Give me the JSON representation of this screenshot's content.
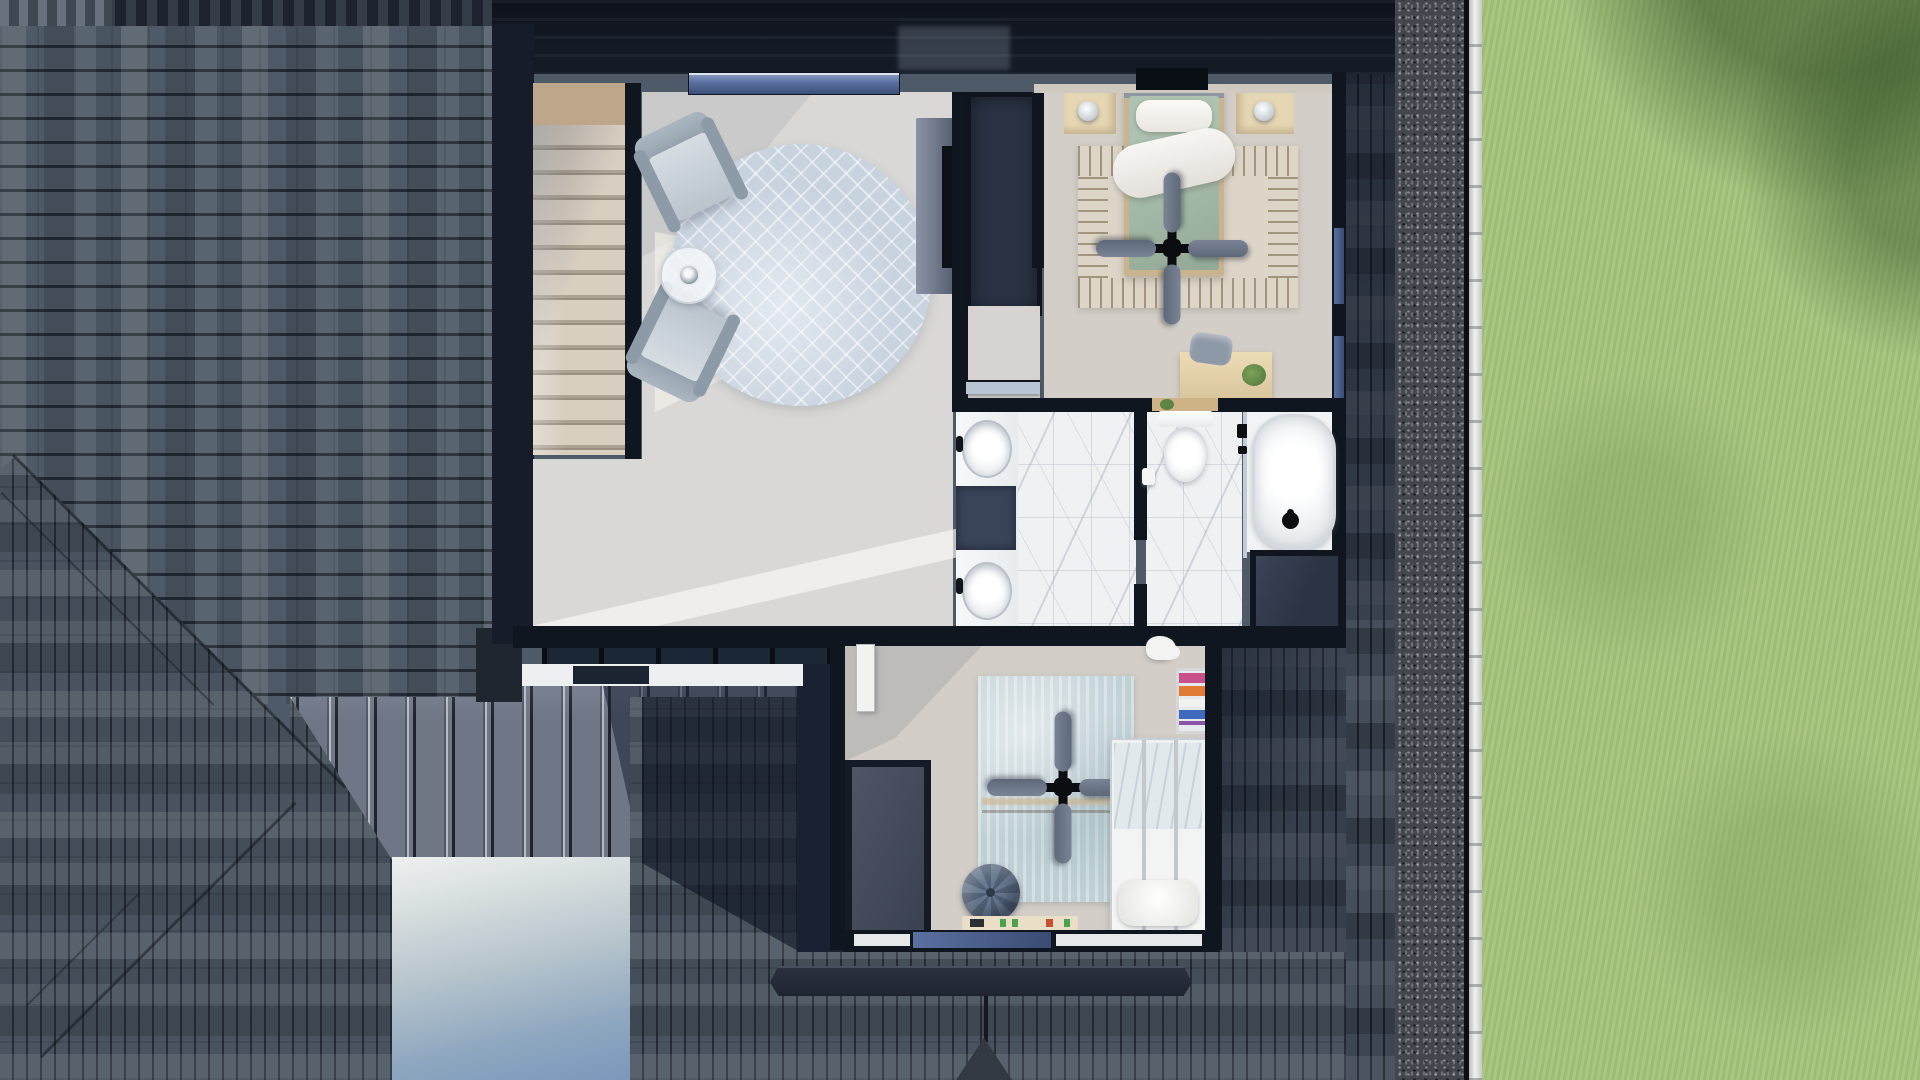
{
  "title": "aerial-cutaway-floor-plan-render",
  "palette": {
    "shingle-base": "#4e5a67",
    "shingle-base2": "#48535f",
    "shingle-dark": "#3d4754",
    "navy": "#141a26",
    "wall": "#10161f",
    "metal": "#6f7787",
    "metal-shadow": "#1c2740",
    "fascia": "#edeff0",
    "gravel": "#43474d",
    "curb": "#e7e7e5",
    "grass": "#a6c47c",
    "grass-shade": "#5f8246",
    "driveway-top": "#eef0ef",
    "driveway-bottom": "#7b98bb",
    "floor": "#dad8d6",
    "carpet": "#d3cec7",
    "marble": "#eff1f3",
    "stair-tread": "#d8cfc1",
    "stair-landing": "#bda689",
    "window-glass": "#5a70a0",
    "living-rug": "#c8d3e0",
    "armchair": "#b9c4cd",
    "bed-green": "#a4b9a7",
    "bedding-white": "#f4f3ef",
    "wood-light": "#e6d7b4",
    "fan-blade": "#6a7586",
    "bedroom2-rug": "#c0d1d6",
    "pouf": "#5d6c82",
    "closet-dark": "#2c3443",
    "book-pink": "#c9508c",
    "book-orange": "#e07a35",
    "book-blue": "#3f69bd",
    "book-purple": "#8a55a8",
    "plant-green": "#5d8345"
  },
  "scene": {
    "view": "top-down aerial of upper storey cutaway surrounded by roof planes",
    "exterior": [
      "asphalt-shingle-roof-horizontal",
      "asphalt-shingle-roof-vertical",
      "hip-ridge-diagonals",
      "standing-seam-metal-roof",
      "roof-shadow",
      "white-fascia-band",
      "chimney-block",
      "concrete-driveway",
      "gravel-border-strip",
      "white-paver-curb",
      "lawn",
      "tree-shadow-on-lawn",
      "ridge-cap-bar",
      "roof-valley"
    ],
    "rooms": [
      {
        "name": "staircase",
        "objects": [
          "wood-landing",
          "carpeted-steps",
          "stair-wall"
        ]
      },
      {
        "name": "loft-living-area",
        "objects": [
          "armchair",
          "armchair",
          "round-glass-side-table",
          "table-lamp",
          "round-patterned-rug",
          "media-console",
          "wall-tv",
          "clerestory-skylight",
          "sunbeam"
        ]
      },
      {
        "name": "bedroom-1",
        "objects": [
          "bed-with-green-duvet",
          "white-pillows",
          "white-throw",
          "nightstand",
          "nightstand",
          "table-lamp",
          "table-lamp",
          "ceiling-fan",
          "patterned-area-rug",
          "desk",
          "desk-chair",
          "potted-plant",
          "walk-in-closet",
          "window-over-bed",
          "east-wall-windows"
        ]
      },
      {
        "name": "hallway",
        "objects": [
          "carpet-floor",
          "open-bathroom-door"
        ]
      },
      {
        "name": "bathroom",
        "objects": [
          "double-vanity",
          "vessel-sink",
          "vessel-sink",
          "vanity-cabinet",
          "marble-tile-floor",
          "partition-wall",
          "toilet",
          "toilet-shelf-with-plant",
          "toilet-paper-roll",
          "shower-glass-panel",
          "shower-hardware",
          "freestanding-bathtub",
          "tub-filler",
          "linen-closet"
        ]
      },
      {
        "name": "bedroom-2",
        "objects": [
          "metal-frame-bed",
          "pillow",
          "light-blue-blanket",
          "ceiling-fan",
          "distressed-blue-rug",
          "tufted-pouf",
          "bookshelf-with-books",
          "plush-toy",
          "toy-strip",
          "open-closet",
          "open-white-door",
          "south-window-band"
        ]
      }
    ]
  }
}
